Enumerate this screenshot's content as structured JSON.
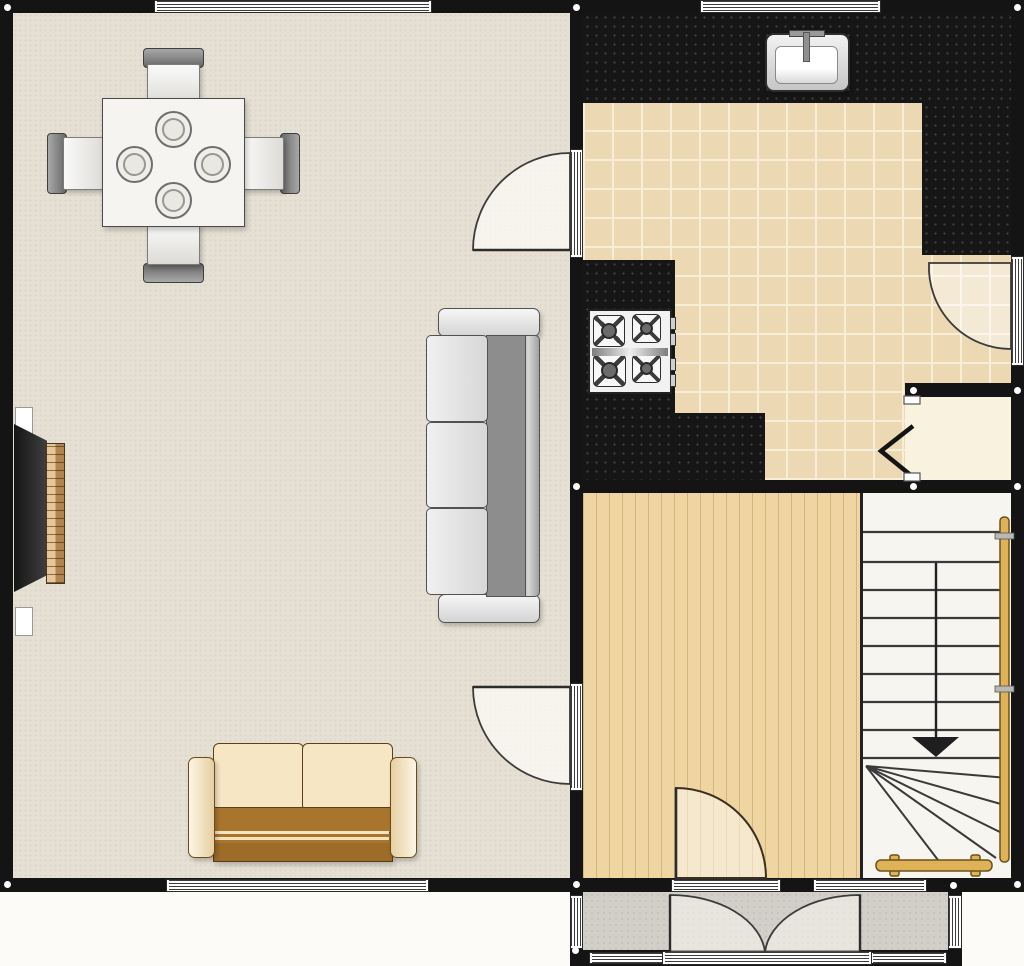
{
  "plan_type": "residential-floorplan-ground-floor",
  "palette": {
    "wall": "#141414",
    "outside": "#fcfbf8",
    "living_floor": "#e6e0d4",
    "kitchen_tile": "#ecd8b2",
    "wood_floor": "#efd5a2",
    "stairs_floor": "#f6f5f0",
    "closet_floor": "#f9f2de",
    "porch_floor": "#d2cfc9",
    "counter": "#161616",
    "rail": "#dfb257",
    "arrow": "#1f1f1f",
    "table": "#f5f4f0",
    "sofa_cushion": "#e4e4e4",
    "sofa_back": "#8d8d8d",
    "loveseat_cushion": "#f6e6c4",
    "loveseat_seat": "#a9752e"
  },
  "rooms": [
    {
      "id": "living-dining-room",
      "floor": "beige-carpet"
    },
    {
      "id": "kitchen",
      "floor": "ceramic-tile"
    },
    {
      "id": "hallway",
      "floor": "wood-plank"
    },
    {
      "id": "staircase",
      "floor": "light"
    },
    {
      "id": "under-stair-closet",
      "floor": "cream"
    },
    {
      "id": "entry-porch",
      "floor": "concrete-gray"
    }
  ],
  "furniture": [
    {
      "id": "dining-table",
      "room": "living-dining-room",
      "chairs": 4,
      "place_settings": 4
    },
    {
      "id": "upright-piano",
      "room": "living-dining-room",
      "against_wall": "left"
    },
    {
      "id": "sofa-three-seat",
      "room": "living-dining-room",
      "facing": "left"
    },
    {
      "id": "loveseat-two-seat",
      "room": "living-dining-room",
      "facing": "up"
    }
  ],
  "fixtures": [
    {
      "id": "kitchen-sink",
      "location": "top-counter"
    },
    {
      "id": "stove-four-burner",
      "location": "left-counter"
    },
    {
      "id": "kitchen-counter-top"
    },
    {
      "id": "kitchen-counter-right"
    },
    {
      "id": "kitchen-counter-left"
    },
    {
      "id": "kitchen-counter-bottom"
    },
    {
      "id": "stair-handrail-vertical"
    },
    {
      "id": "stair-handrail-bottom"
    }
  ],
  "doors": [
    {
      "id": "living-to-kitchen-door",
      "type": "single-swing",
      "swings_into": "living-dining-room"
    },
    {
      "id": "living-to-hall-door",
      "type": "single-swing",
      "swings_into": "living-dining-room"
    },
    {
      "id": "front-door",
      "type": "single-swing",
      "swings_into": "hallway"
    },
    {
      "id": "back-door",
      "type": "single-swing",
      "swings_into": "kitchen"
    },
    {
      "id": "closet-bifold-door",
      "type": "bifold"
    },
    {
      "id": "porch-double-doors",
      "type": "double-swing",
      "swings_into": "entry-porch"
    }
  ],
  "windows": [
    {
      "id": "living-top-window"
    },
    {
      "id": "kitchen-top-window"
    },
    {
      "id": "living-bottom-window"
    },
    {
      "id": "hall-bottom-window"
    },
    {
      "id": "porch-left-window"
    },
    {
      "id": "porch-right-window"
    },
    {
      "id": "porch-bottom-left-window"
    },
    {
      "id": "porch-bottom-right-window"
    }
  ],
  "stairs": {
    "straight_treads": 9,
    "winder_treads": 5,
    "direction_arrow": "down"
  }
}
